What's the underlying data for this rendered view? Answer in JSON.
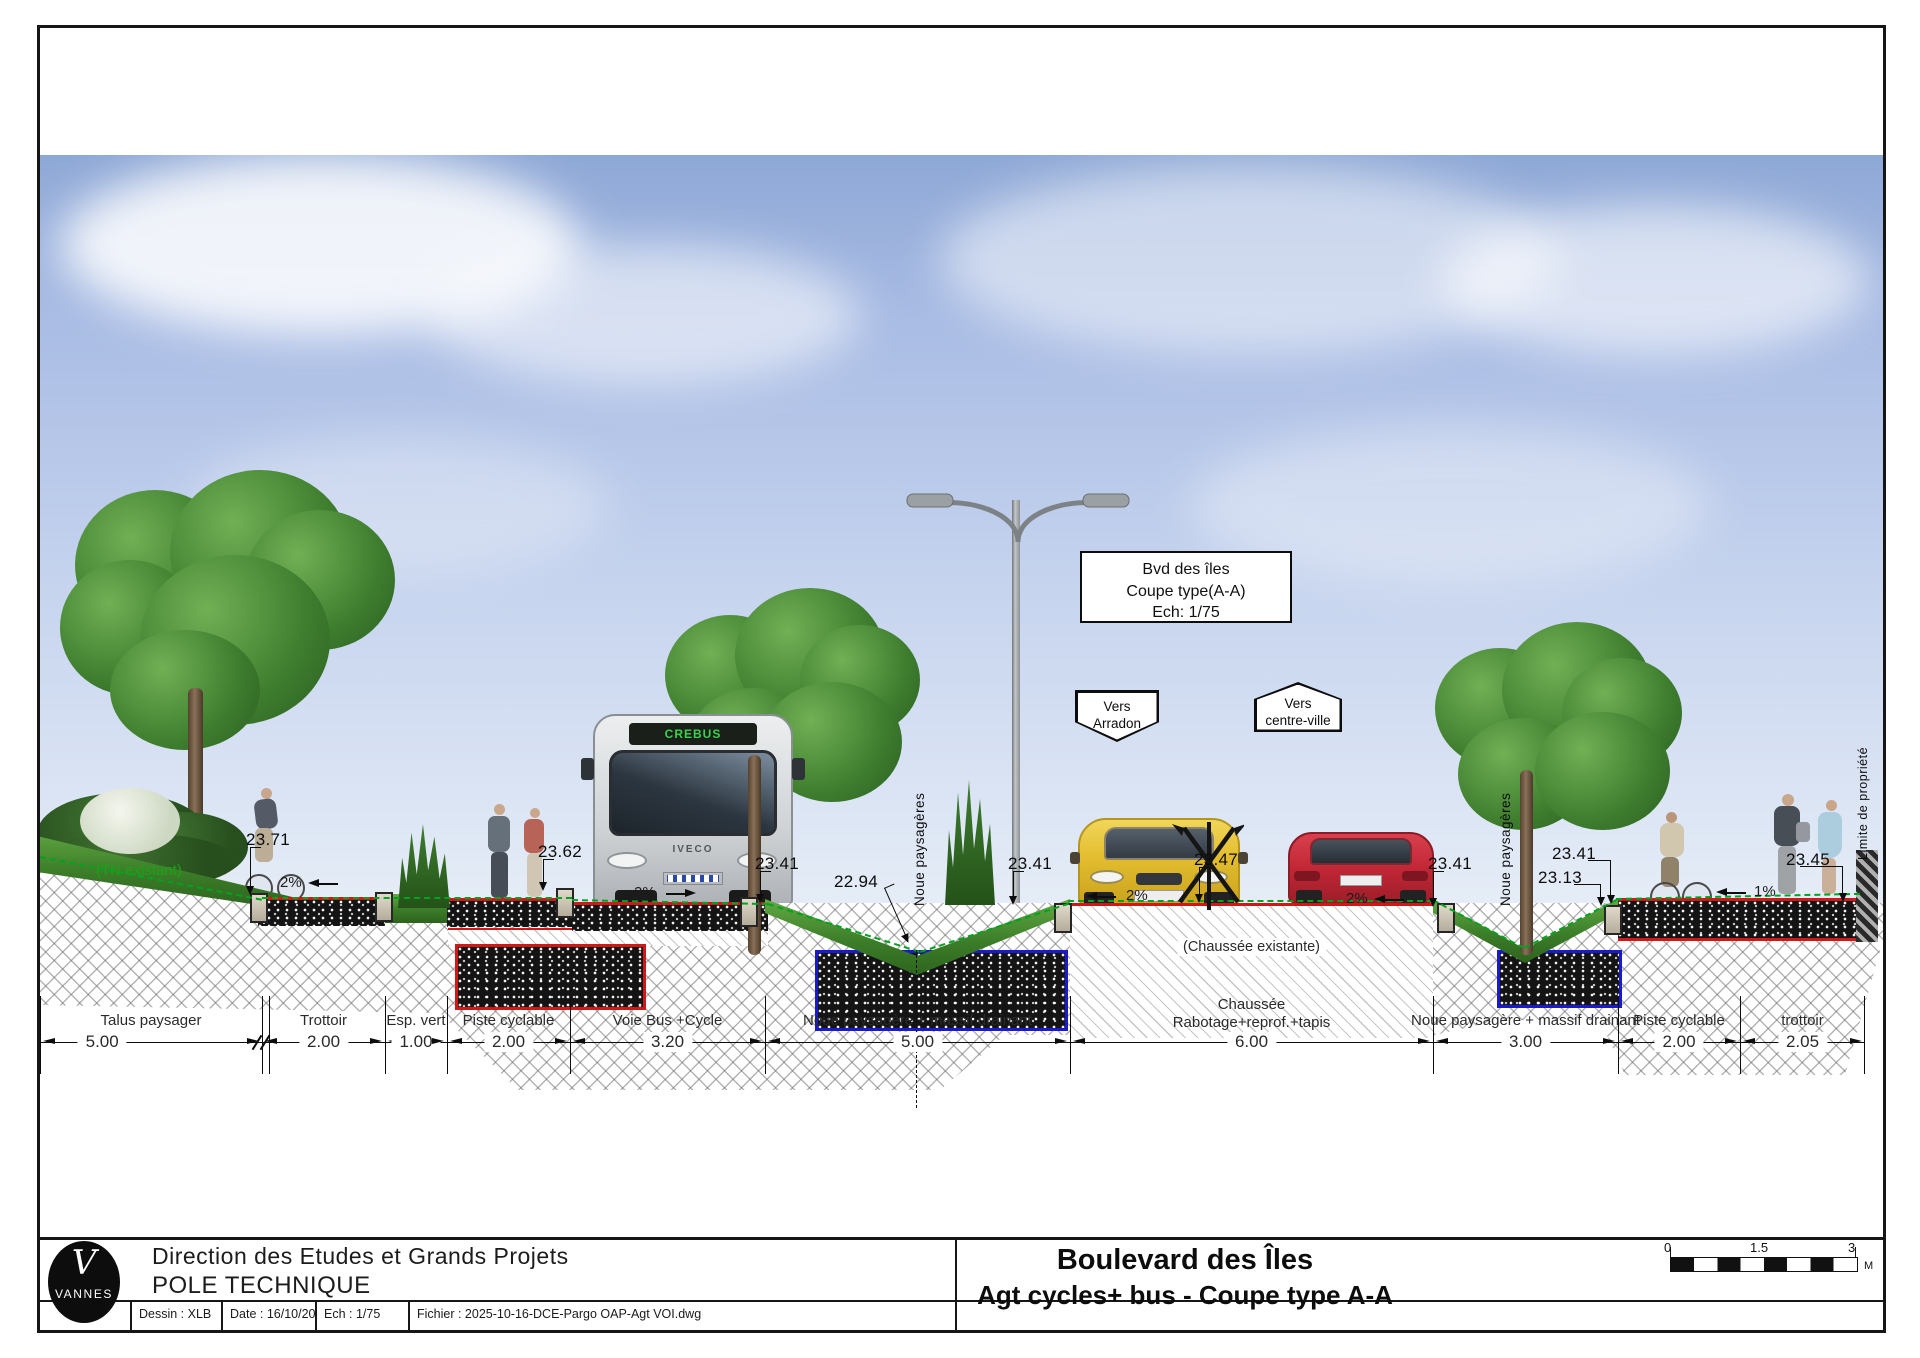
{
  "sheet": {
    "callout_box": {
      "line1": "Bvd des îles",
      "line2": "Coupe type(A-A)",
      "line3": "Ech: 1/75"
    },
    "signs": {
      "left": {
        "line1": "Vers",
        "line2": "Arradon"
      },
      "right": {
        "line1": "Vers",
        "line2": "centre-ville"
      }
    },
    "labels": {
      "tn_existant": "(TN existant)",
      "chaussee_existante": "(Chaussée existante)",
      "noue_left": "Noue paysagères",
      "noue_right": "Noue paysagères",
      "limite_propriete": "Limite de propriété"
    },
    "bus": {
      "brand": "IVECO",
      "display": "CREBUS"
    },
    "elevations": [
      "23.71",
      "23.62",
      "23.41",
      "22.94",
      "23.41",
      "23.47",
      "23.41",
      "23.41",
      "23.13",
      "23.45"
    ],
    "slopes": [
      "2%",
      "2%",
      "2%",
      "2%",
      "1%"
    ],
    "colors": {
      "accent_red": "#d01818",
      "accent_blue": "#1a1acc",
      "tn_green": "#00a31e"
    }
  },
  "dimensions": {
    "segments": [
      {
        "label": "Talus paysager",
        "value": "5.00"
      },
      {
        "label": "Trottoir",
        "value": "2.00"
      },
      {
        "label": "Esp. vert",
        "value": "1.00"
      },
      {
        "label": "Piste cyclable",
        "value": "2.00"
      },
      {
        "label": "Voie Bus +Cycle",
        "value": "3.20"
      },
      {
        "label": "Noue paysagère + massif drainant",
        "value": "5.00"
      },
      {
        "label": "Chaussée",
        "label2": "Rabotage+reprof.+tapis",
        "value": "6.00"
      },
      {
        "label": "Noue paysagère + massif drainant",
        "value": "3.00"
      },
      {
        "label": "Piste cyclable",
        "value": "2.00"
      },
      {
        "label": "trottoir",
        "value": "2.05"
      }
    ]
  },
  "title_block": {
    "logo": {
      "initial": "V",
      "name": "VANNES"
    },
    "org_line1": "Direction des Etudes et Grands Projets",
    "org_line2": "POLE TECHNIQUE",
    "title_line1": "Boulevard des Îles",
    "title_line2": "Agt cycles+ bus - Coupe type A-A",
    "cells": {
      "dessin": "Dessin : XLB",
      "date": "Date : 16/10/2025",
      "ech": "Ech : 1/75",
      "fichier": "Fichier : 2025-10-16-DCE-Pargo OAP-Agt VOI.dwg"
    },
    "scale_bar": {
      "t0": "0",
      "t1": "1.5",
      "t2": "3",
      "unit": "M"
    }
  }
}
